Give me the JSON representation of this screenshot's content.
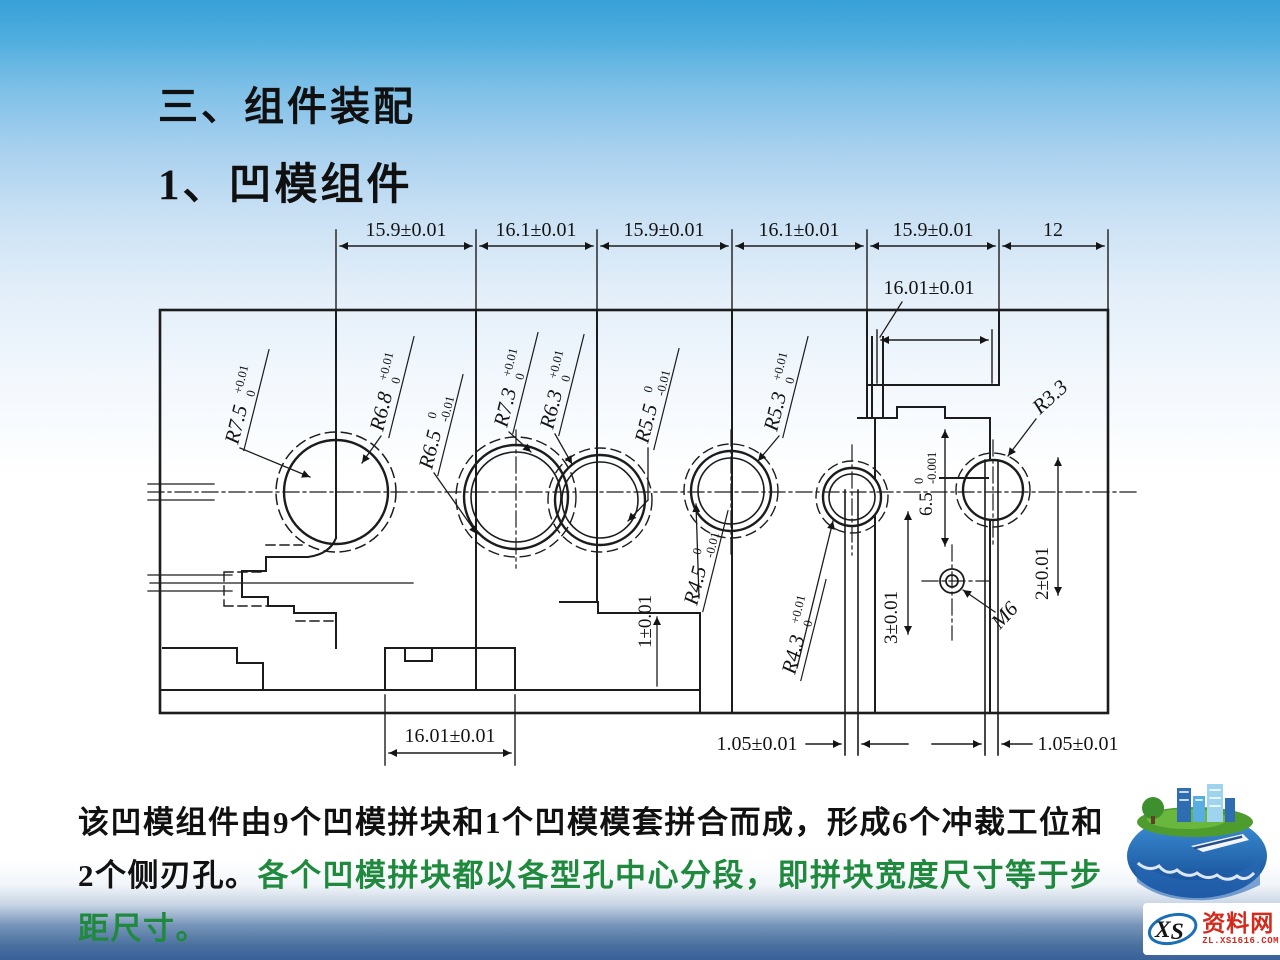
{
  "slide": {
    "title_line1": "三、组件装配",
    "title_line2": "1、凹模组件",
    "body_line1": "该凹模组件由9个凹模拼块和1个凹模模套拼合而成，形成6个冲裁工位和",
    "body_line2_black": "2个侧刃孔。",
    "body_line2_green": "各个凹模拼块都以各型孔中心分段，即拼块宽度尺寸等于步",
    "body_line3_green": "距尺寸。",
    "colors": {
      "title": "#101010",
      "body_black": "#111111",
      "body_green": "#1f8a3d",
      "top_band": "#37a0d8",
      "bottom_band": "#3a629a",
      "line": "#1c1c1c"
    }
  },
  "drawing": {
    "top_dims": [
      "15.9±0.01",
      "16.1±0.01",
      "15.9±0.01",
      "16.1±0.01",
      "15.9±0.01",
      "12"
    ],
    "dim_top_right": "16.01±0.01",
    "dim_bottom_left": "16.01±0.01",
    "dim_bottom_mid": "1.05±0.01",
    "dim_bottom_right": "1.05±0.01",
    "radius_labels": [
      {
        "text": "R7.5",
        "tol_top": "+0.01",
        "tol_bottom": "0"
      },
      {
        "text": "R6.8",
        "tol_top": "+0.01",
        "tol_bottom": "0"
      },
      {
        "text": "R6.5",
        "tol_top": "0",
        "tol_bottom": "-0.01"
      },
      {
        "text": "R7.3",
        "tol_top": "+0.01",
        "tol_bottom": "0"
      },
      {
        "text": "R6.3",
        "tol_top": "+0.01",
        "tol_bottom": "0"
      },
      {
        "text": "R5.5",
        "tol_top": "0",
        "tol_bottom": "-0.01"
      },
      {
        "text": "R4.5",
        "tol_top": "0",
        "tol_bottom": "-0.01"
      },
      {
        "text": "R5.3",
        "tol_top": "+0.01",
        "tol_bottom": "0"
      },
      {
        "text": "R4.3",
        "tol_top": "+0.01",
        "tol_bottom": "0"
      },
      {
        "text": "R3.3",
        "tol_top": "",
        "tol_bottom": ""
      }
    ],
    "dim_1": "1±0.01",
    "dim_3": "3±0.01",
    "dim_65": {
      "text": "6.5",
      "tol_top": "0",
      "tol_bottom": "-0.001"
    },
    "dim_2": "2±0.01",
    "thread": "M6"
  },
  "watermark": {
    "xs": "XS",
    "name": "资料网",
    "url": "ZL.XS1616.COM"
  }
}
